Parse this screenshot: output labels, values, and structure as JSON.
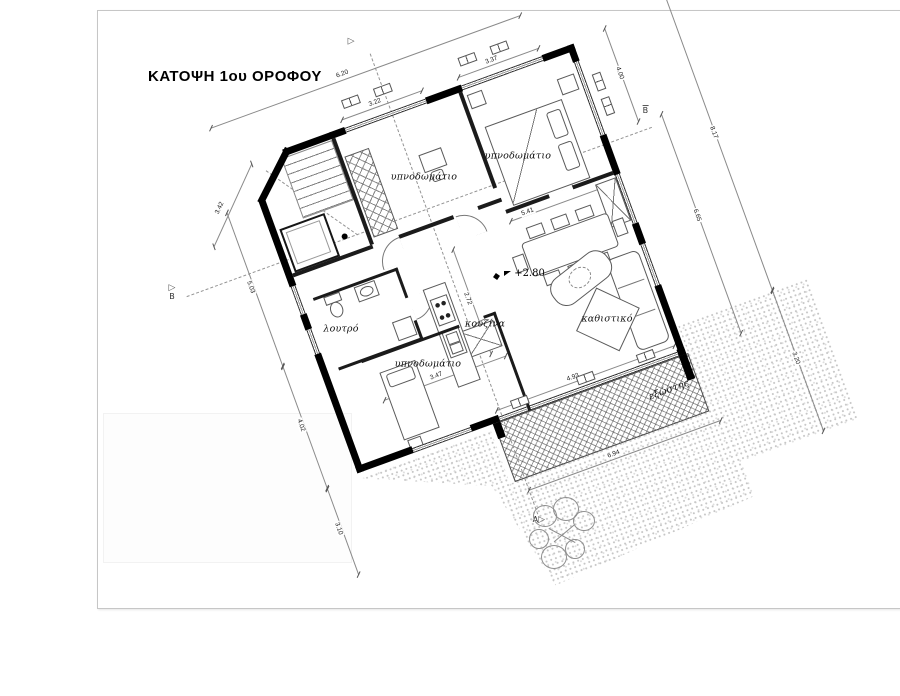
{
  "sheet": {
    "title": "ΚΑΤΟΨΗ 1ου ΟΡΟΦΟΥ"
  },
  "rooms": {
    "bedroom_top_left": "υπνοδωμάτιο",
    "bedroom_top_right": "υπνοδωμάτιο",
    "bedroom_bottom": "υπνοδωμάτιο",
    "bathroom": "λουτρό",
    "kitchen": "κουζίνα",
    "living_room": "καθιστικό",
    "balcony": "εξώστης"
  },
  "annotations": {
    "level": "+2.80"
  },
  "section_markers": {
    "a": "A",
    "b": "B"
  },
  "dimensions": {
    "top_overall": "6.20",
    "chamfer": "3.42",
    "left_upper": "5.03",
    "left_lower": "4.02",
    "left_below": "3.10",
    "right_upper": "4.00",
    "right_side": "6.65",
    "plot_right_upper": "8.17",
    "plot_right_lower": "3.20",
    "window_bedroom1": "3.22",
    "window_bedroom2": "3.37",
    "dining_width": "5.41",
    "bedroom3_width": "3.47",
    "living_front": "4.93",
    "balcony_length": "6.94",
    "kitchen_side": "2.72"
  }
}
